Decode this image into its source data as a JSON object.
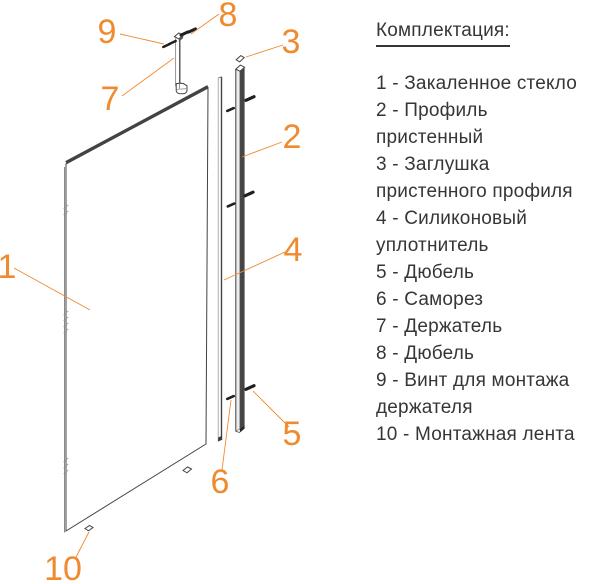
{
  "legend": {
    "title": "Комплектация:",
    "items": [
      "1 - Закаленное стекло",
      "2 - Профиль\nпристенный",
      "3 - Заглушка\nпристенного профиля",
      "4 - Силиконовый\nуплотнитель",
      "5 - Дюбель",
      "6 - Саморез",
      "7 - Держатель",
      "8 - Дюбель",
      "9 - Винт для монтажа\nдержателя",
      "10 - Монтажная лента"
    ]
  },
  "callouts": [
    "1",
    "2",
    "3",
    "4",
    "5",
    "6",
    "7",
    "8",
    "9",
    "10"
  ],
  "colors": {
    "accent": "#EF8A2F",
    "ink": "#434343",
    "text": "#363636",
    "hatch": "#BABABA"
  }
}
